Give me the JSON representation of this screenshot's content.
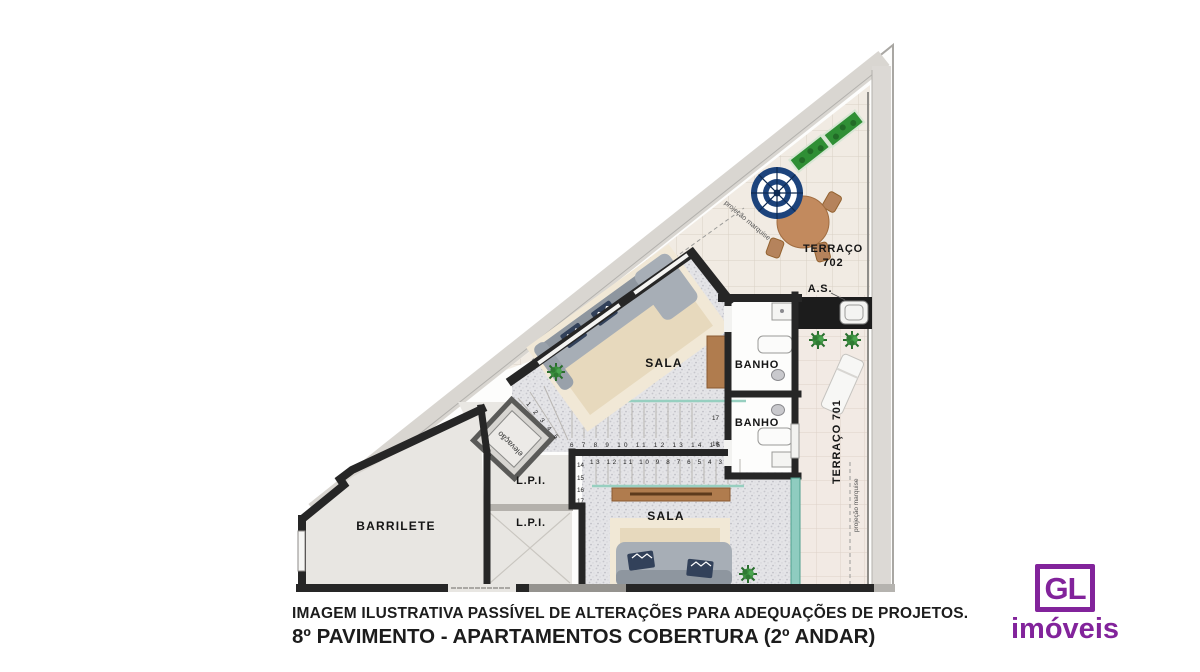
{
  "caption": {
    "line1": "IMAGEM ILUSTRATIVA PASSÍVEL DE ALTERAÇÕES PARA ADEQUAÇÕES DE PROJETOS.",
    "line2": "8º PAVIMENTO - APARTAMENTOS COBERTURA (2º ANDAR)"
  },
  "logo": {
    "monogram": "GL",
    "name": "imóveis",
    "color": "#82239B"
  },
  "rooms": {
    "terraco702_line1": "TERRAÇO",
    "terraco702_line2": "702",
    "terraco701": "TERRAÇO  701",
    "sala_upper": "SALA",
    "sala_lower": "SALA",
    "banho_upper": "BANHO",
    "banho_lower": "BANHO",
    "barrilete": "BARRILETE",
    "lpi_upper": "L.P.I.",
    "lpi_lower": "L.P.I.",
    "as_label": "A.S.",
    "elevator": "elevação",
    "marquise_702": "projeção marquise",
    "marquise_701": "projeção marquise"
  },
  "stairs": {
    "upper_run": "6 7 8 9 10 11 12 13 14 15",
    "lower_run": "13 12 11 10 9 8 7 6 5 4 3",
    "winders": "1 2 3 4 5",
    "left_numbers": [
      "14",
      "15",
      "16",
      "17"
    ],
    "right_numbers": [
      "17",
      "16"
    ]
  },
  "colors": {
    "accent_purple": "#82239B",
    "wall": "#262626",
    "teal_glass": "#8FCCC0",
    "wood": "#B07C4E",
    "plant_green": "#3A8F3E",
    "pillow_navy": "#32415A",
    "umbrella_navy": "#1C437C"
  }
}
